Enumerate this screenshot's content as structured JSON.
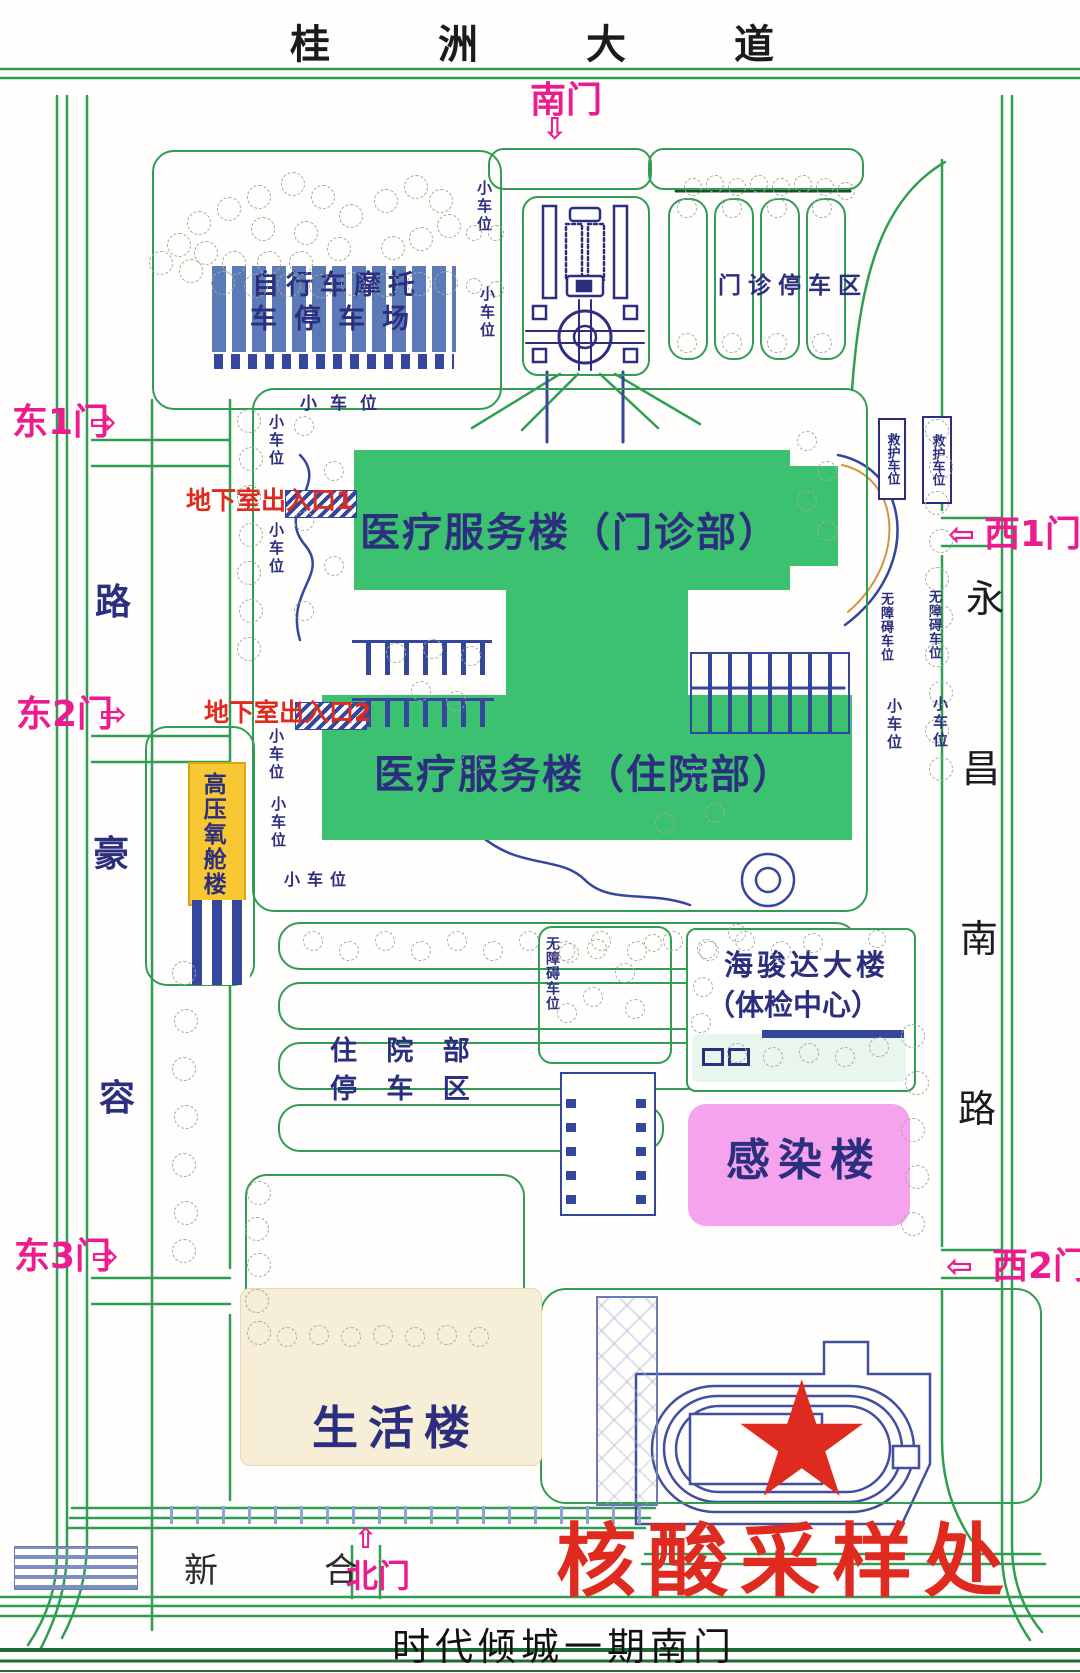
{
  "canvas": {
    "width": 1080,
    "height": 1673
  },
  "colors": {
    "road_green": "#2f9e53",
    "dark_green": "#1f6b35",
    "building_green": "#3cc170",
    "navy": "#2b2f7e",
    "blue": "#35479c",
    "bar_blue": "#5d7ab8",
    "magenta": "#ec1c8e",
    "red": "#df2a1f",
    "yellow": "#f8c832",
    "yellow_border": "#d9a514",
    "pink": "#f4a3ec",
    "cream": "#f6eed7",
    "tree": "#9fae9f",
    "black": "#1b1b1b",
    "tan": "#d2953f"
  },
  "roads": {
    "top_avenue": "桂洲大道",
    "bottom_gate_label": "时代倾城一期南门",
    "left_road_chars": [
      "路",
      "豪",
      "容"
    ],
    "right_road_chars": [
      "永",
      "昌",
      "南",
      "路"
    ],
    "north_road_chars": [
      "新",
      "合"
    ]
  },
  "gates": {
    "south": "南门",
    "east1": "东1门",
    "east2": "东2门",
    "east3": "东3门",
    "west1": "西1门",
    "west2": "西2门",
    "north": "北门"
  },
  "icons": {
    "arrow_down": "⇩",
    "arrow_up": "⇧",
    "arrow_left": "⇦",
    "arrow_right": "⇨",
    "star": "★"
  },
  "buildings": {
    "outpatient": "医疗服务楼（门诊部）",
    "inpatient": "医疗服务楼（住院部）",
    "hyperbaric": "高压氧舱楼",
    "haijunda_line1": "海骏达大楼",
    "haijunda_line2": "（体检中心）",
    "infection": "感染楼",
    "life": "生活楼"
  },
  "parking": {
    "bike_line1": "自行车摩托",
    "bike_line2": "车停车场",
    "outpatient_area": "门诊停车区",
    "inpatient_area_line1": "住 院 部",
    "inpatient_area_line2": "停 车 区",
    "small_car": "小车位",
    "accessible": "无障碍车位",
    "ambulance": "救护车位"
  },
  "labels": {
    "basement_exit_1": "地下室出入口1",
    "basement_exit_2": "地下室出入口2",
    "nucleic_acid": "核酸采样处"
  }
}
